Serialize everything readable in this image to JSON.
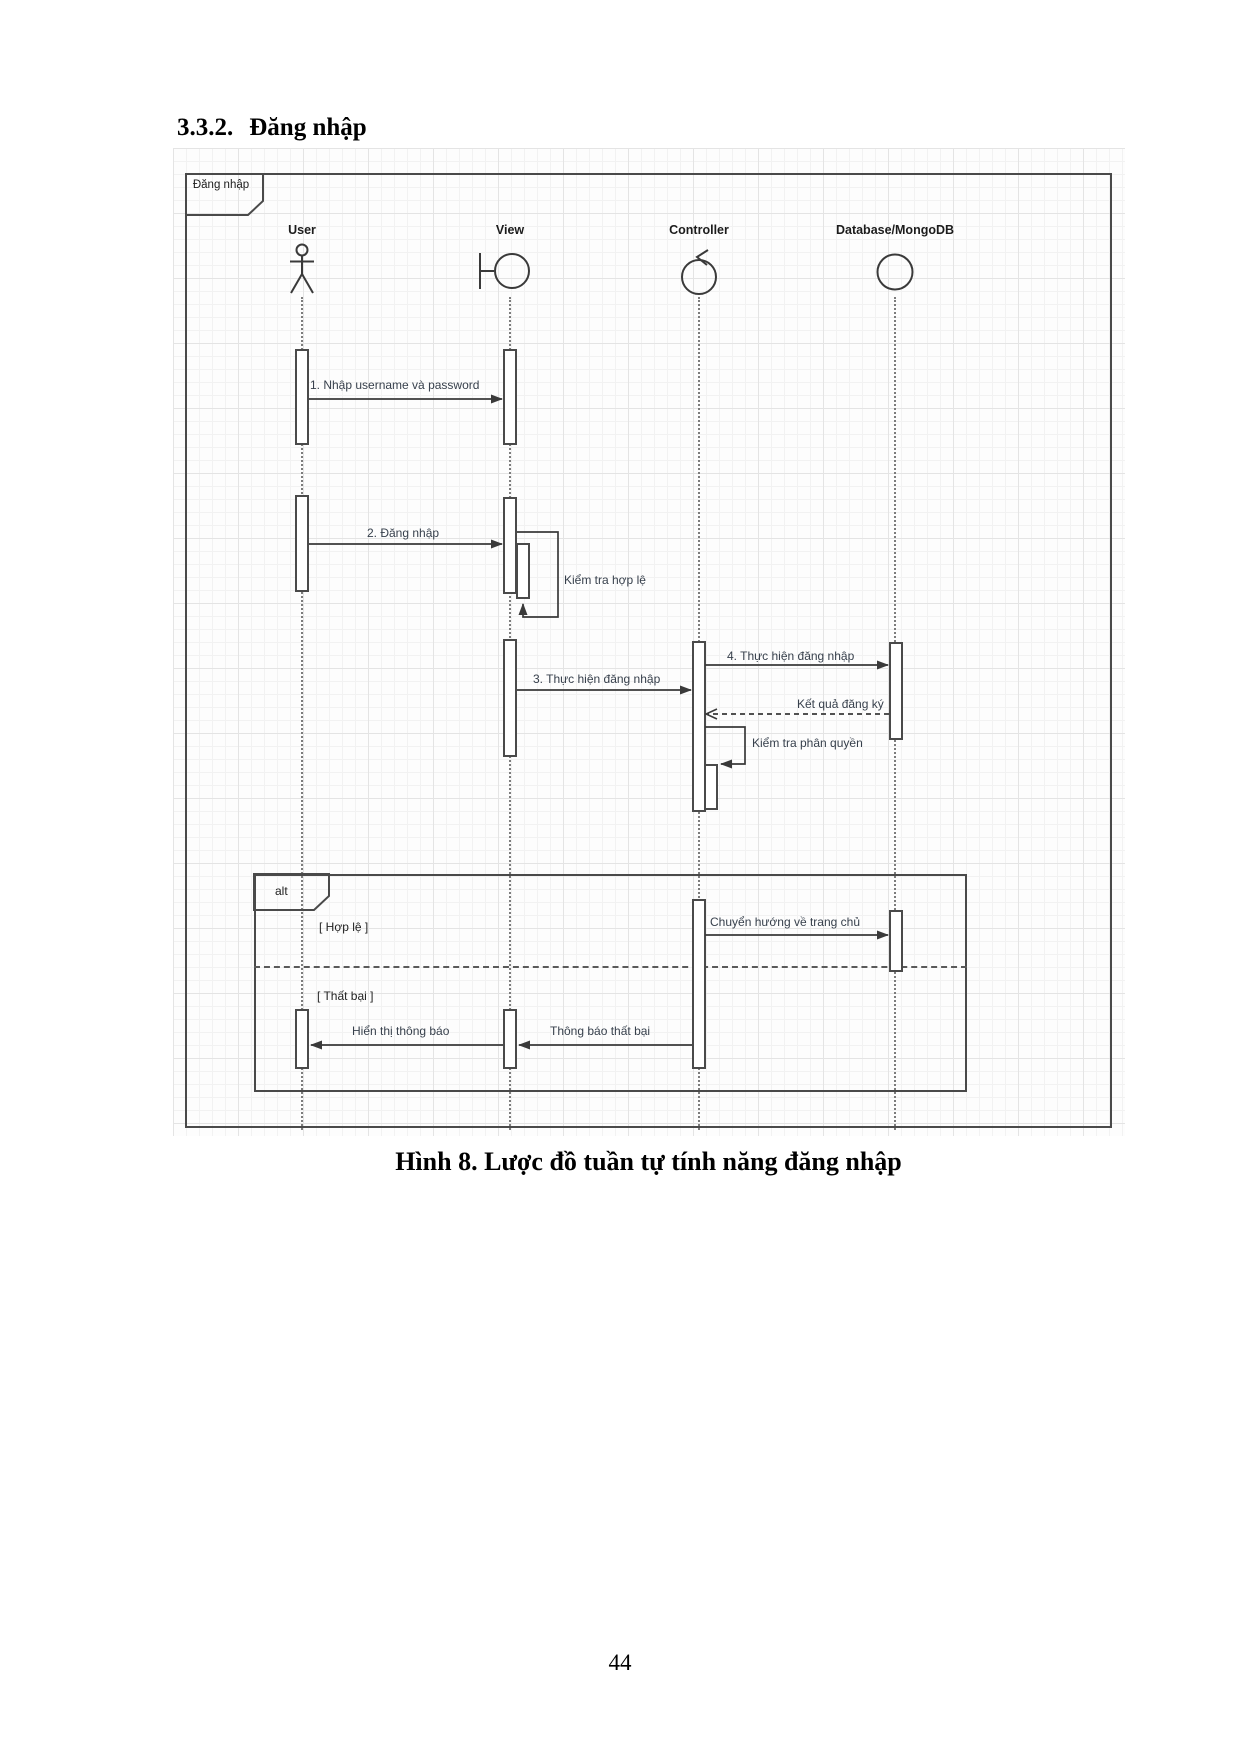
{
  "page": {
    "heading_number": "3.3.2.",
    "heading_title": "Đăng nhập",
    "caption": "Hình 8. Lược đồ tuần tự tính năng đăng nhập",
    "page_number": "44"
  },
  "diagram": {
    "frame_title": "Đăng nhập",
    "lifelines": [
      {
        "label": "User",
        "icon": "actor"
      },
      {
        "label": "View",
        "icon": "boundary"
      },
      {
        "label": "Controller",
        "icon": "control"
      },
      {
        "label": "Database/MongoDB",
        "icon": "entity"
      }
    ],
    "messages": {
      "m1": "1. Nhập username và  password",
      "m2": "2. Đăng nhập",
      "check_valid": "Kiểm tra hợp lệ",
      "m3": "3. Thực hiện đăng nhập",
      "m4": "4. Thực hiện đăng nhập",
      "return_result": "Kết quả đăng ký",
      "check_permission": "Kiểm tra phân quyền",
      "redirect": "Chuyển hướng về trang chủ",
      "show_notice": "Hiển thị thông báo",
      "fail_notice": "Thông báo thất bại"
    },
    "alt": {
      "label": "alt",
      "guard_valid": "[ Hợp lệ ]",
      "guard_fail": "[ Thất bại ]"
    },
    "colors": {
      "frame_line": "#4a4a4a",
      "arrow_line": "#3a3a3a",
      "label_text": "#37404c",
      "grid_minor": "#f2f2f2",
      "grid_major": "#e4e4e4"
    }
  }
}
